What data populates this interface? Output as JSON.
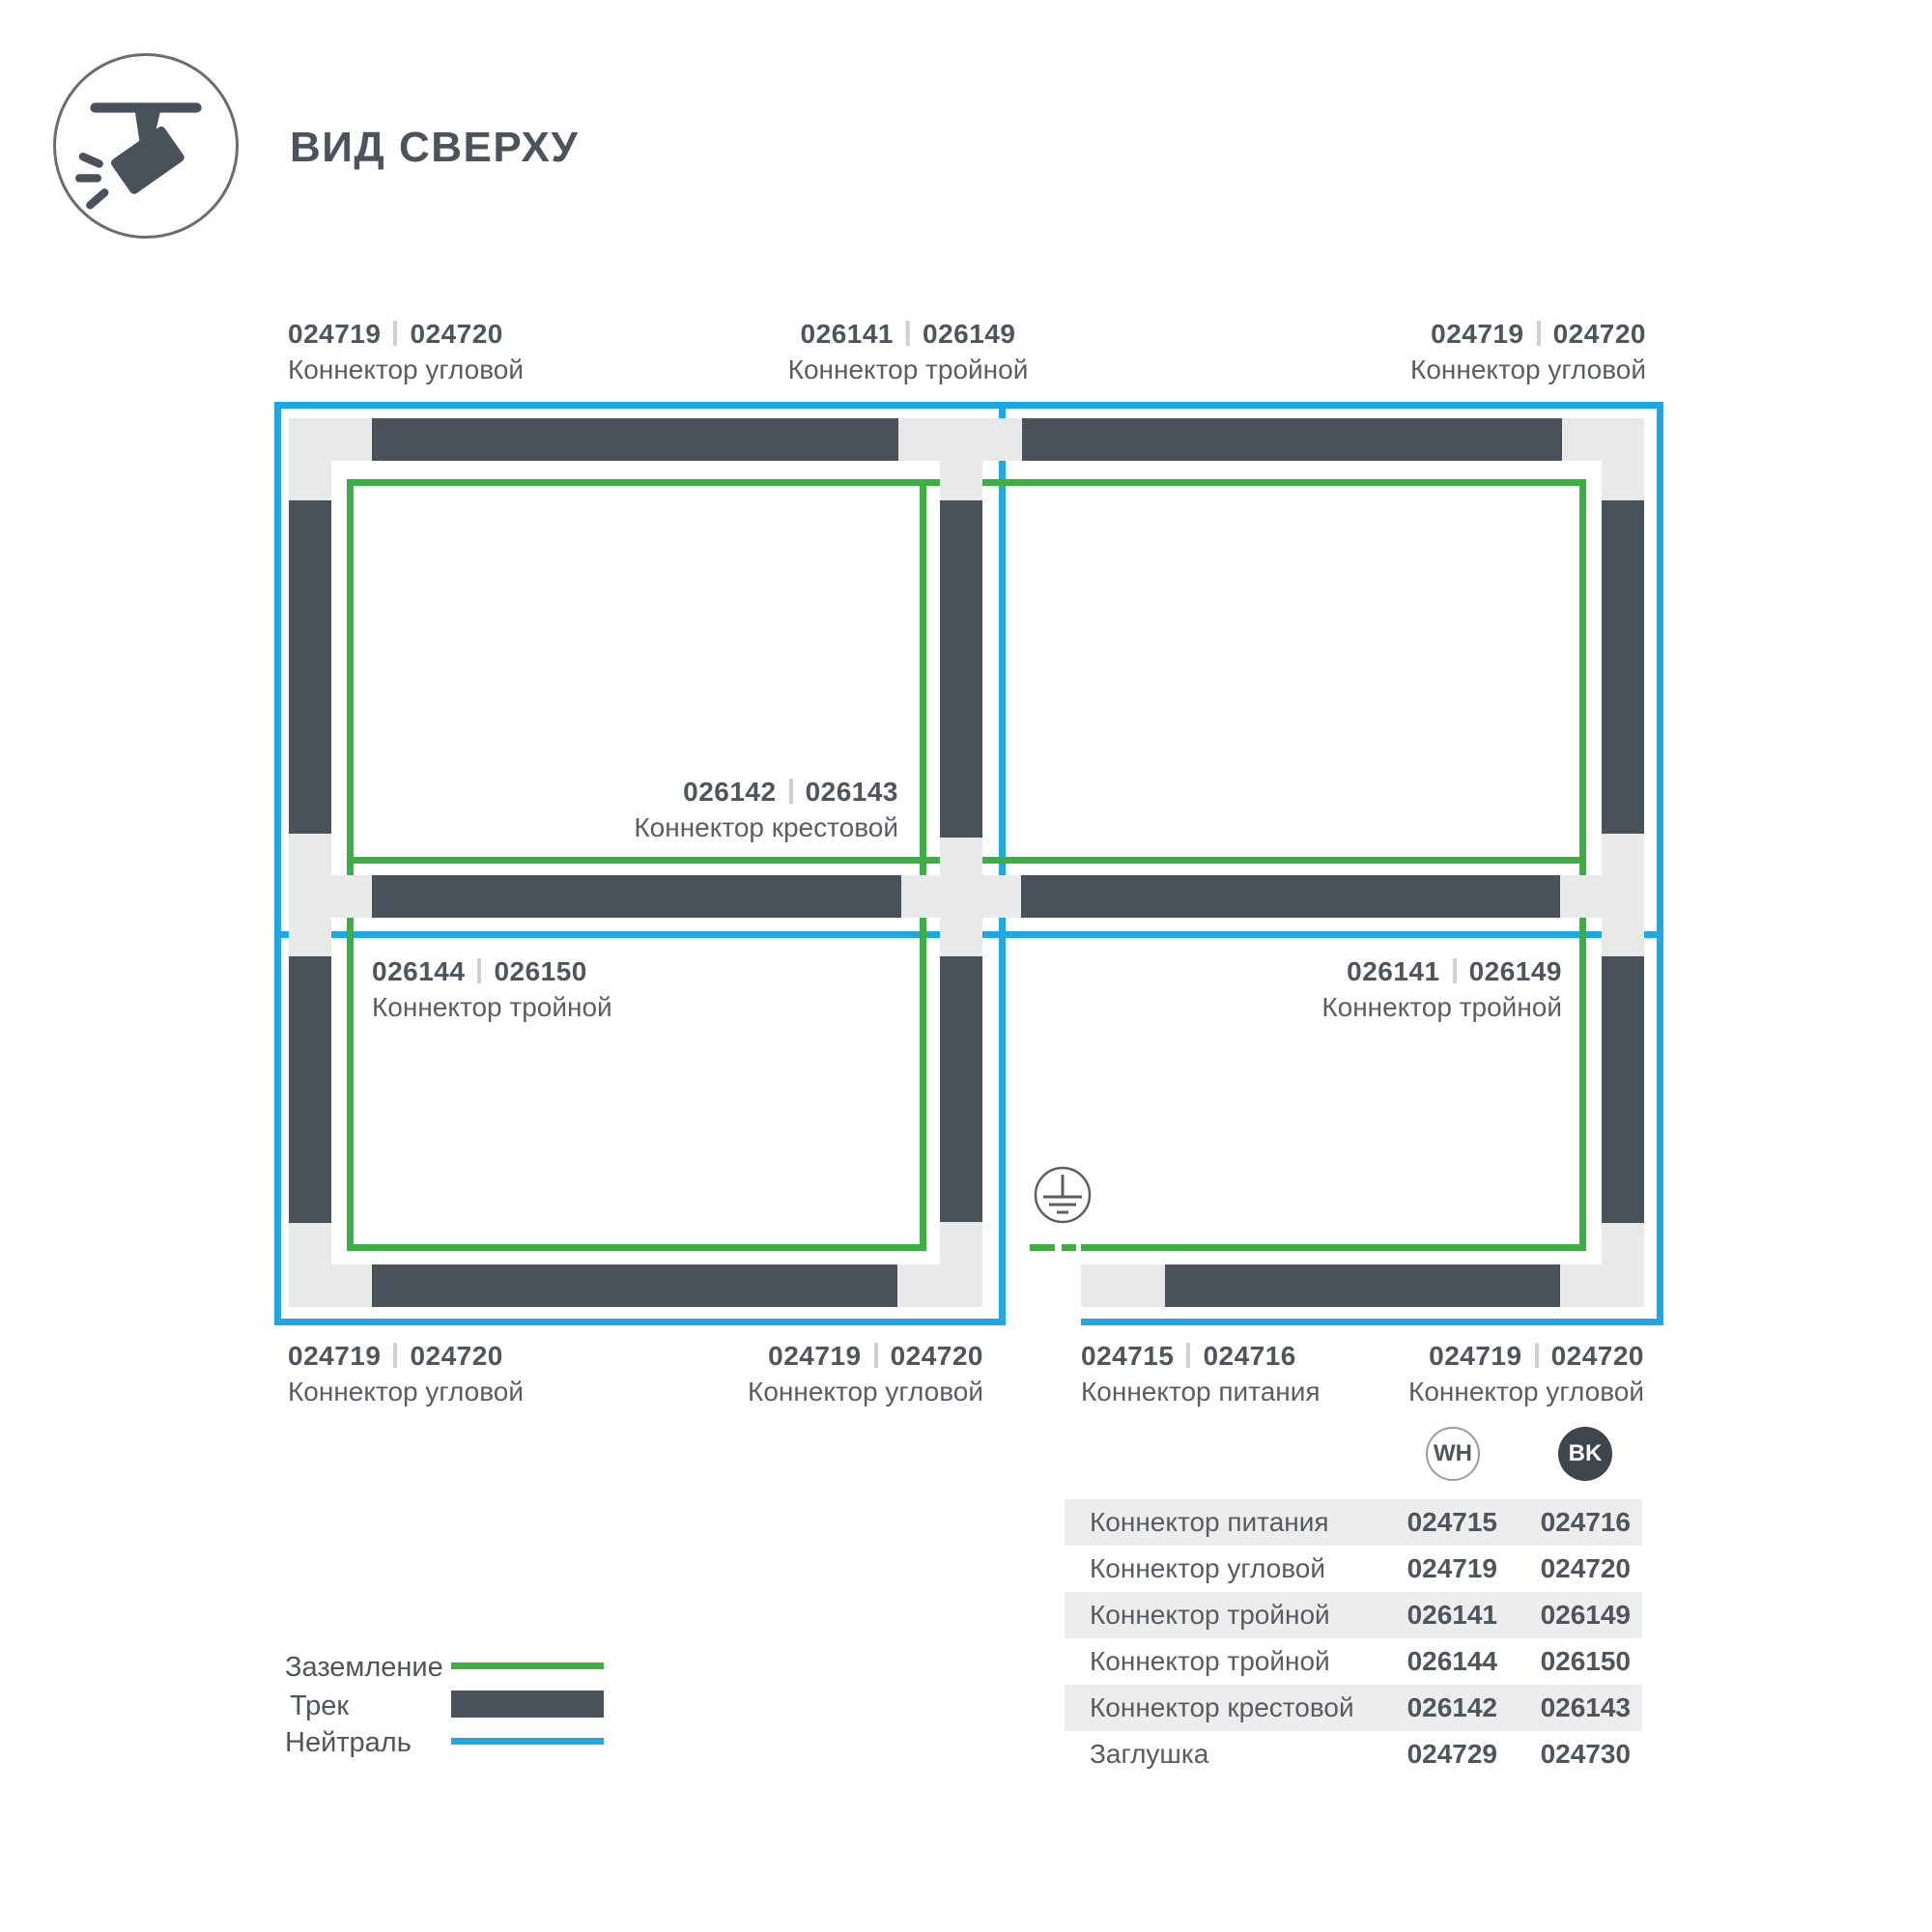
{
  "header": {
    "title": "ВИД СВЕРХУ"
  },
  "colors": {
    "ground_green": "#3dad44",
    "neutral_blue": "#1ea7e1",
    "track_dark": "#49525a",
    "connector_block": "#e8eaea",
    "badge_bk_fill": "#3e454b",
    "text_dark": "#4e555b"
  },
  "diagram": {
    "labels": [
      {
        "num1": "024719",
        "num2": "024720",
        "name": "Коннектор угловой"
      },
      {
        "num1": "026141",
        "num2": "026149",
        "name": "Коннектор тройной"
      },
      {
        "num1": "024719",
        "num2": "024720",
        "name": "Коннектор угловой"
      },
      {
        "num1": "026142",
        "num2": "026143",
        "name": "Коннектор крестовой"
      },
      {
        "num1": "026144",
        "num2": "026150",
        "name": "Коннектор тройной"
      },
      {
        "num1": "026141",
        "num2": "026149",
        "name": "Коннектор тройной"
      },
      {
        "num1": "024719",
        "num2": "024720",
        "name": "Коннектор угловой"
      },
      {
        "num1": "024719",
        "num2": "024720",
        "name": "Коннектор угловой"
      },
      {
        "num1": "024715",
        "num2": "024716",
        "name": "Коннектор питания"
      },
      {
        "num1": "024719",
        "num2": "024720",
        "name": "Коннектор угловой"
      }
    ]
  },
  "legend": {
    "items": [
      {
        "label": "Заземление",
        "swatch": "ground-line"
      },
      {
        "label": "Трек",
        "swatch": "track-bar"
      },
      {
        "label": "Нейтраль",
        "swatch": "neutral-line"
      }
    ]
  },
  "table": {
    "columns": [
      {
        "badge": "WH"
      },
      {
        "badge": "BK"
      }
    ],
    "rows": [
      {
        "name": "Коннектор питания",
        "wh": "024715",
        "bk": "024716"
      },
      {
        "name": "Коннектор угловой",
        "wh": "024719",
        "bk": "024720"
      },
      {
        "name": "Коннектор тройной",
        "wh": "026141",
        "bk": "026149"
      },
      {
        "name": "Коннектор тройной",
        "wh": "026144",
        "bk": "026150"
      },
      {
        "name": "Коннектор крестовой",
        "wh": "026142",
        "bk": "026143"
      },
      {
        "name": "Заглушка",
        "wh": "024729",
        "bk": "024730"
      }
    ]
  }
}
